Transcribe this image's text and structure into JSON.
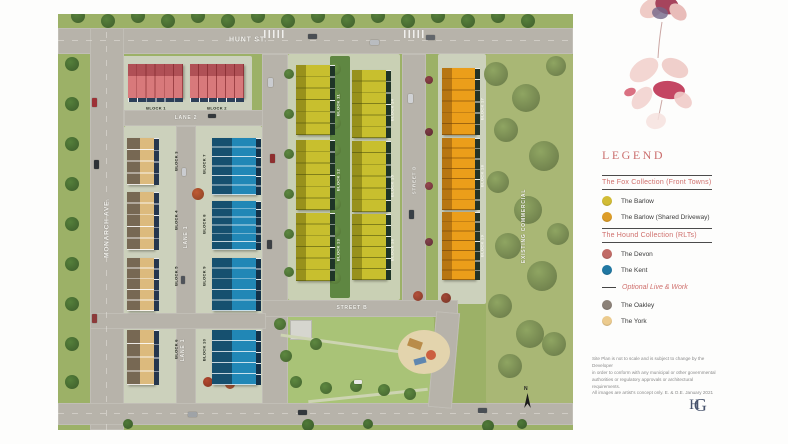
{
  "legend": {
    "title": "LEGEND",
    "sections": [
      {
        "style": "boxed",
        "heading": "The Fox Collection (Front Towns)",
        "items": [
          {
            "color": "#d2bc35",
            "label": "The Barlow"
          },
          {
            "color": "#dd9d28",
            "label": "The Barlow (Shared Driveway)"
          }
        ]
      },
      {
        "style": "boxed",
        "heading": "The Hound Collection (RLTs)",
        "items": [
          {
            "color": "#c16b66",
            "label": "The Devon"
          },
          {
            "color": "#2178a3",
            "label": "The Kent"
          }
        ]
      },
      {
        "style": "dash",
        "heading": "Optional Live & Work",
        "items": [
          {
            "color": "#8b8178",
            "label": "The Oakley"
          },
          {
            "color": "#eccb8e",
            "label": "The York"
          }
        ]
      }
    ],
    "disclaimer_lines": [
      "Site Plan is not to scale and is subject to change by the Developer",
      "in order to conform with any municipal or other governmental",
      "authorities or regulatory approvals or architectural requirements.",
      "All images are artist's concept only. E. & O.E. January 2021"
    ],
    "logo_h": "H",
    "logo_g": "G"
  },
  "siteplan": {
    "street_labels": [
      {
        "name": "HUNT ST.",
        "x": 190,
        "y": 26,
        "rot": 0,
        "size": 7
      },
      {
        "name": "MONARCH AVE.",
        "x": 49,
        "y": 214,
        "rot": -90,
        "size": 6.5
      },
      {
        "name": "LANE 2",
        "x": 128,
        "y": 104,
        "rot": 0,
        "size": 5
      },
      {
        "name": "LANE 1",
        "x": 128,
        "y": 223,
        "rot": -90,
        "size": 5
      },
      {
        "name": "LANE 1",
        "x": 125,
        "y": 336,
        "rot": -90,
        "size": 5
      },
      {
        "name": "STREET B",
        "x": 294,
        "y": 294,
        "rot": 0,
        "size": 5
      },
      {
        "name": "STREET D",
        "x": 356,
        "y": 166,
        "rot": -90,
        "size": 4.5
      }
    ],
    "area_labels": [
      {
        "name": "EXISTING COMMERCIAL",
        "x": 466,
        "y": 212,
        "rot": -90,
        "size": 5
      }
    ],
    "blocks": [
      {
        "label": "BLOCK 1",
        "type": "devon",
        "x": 70,
        "y": 50,
        "w": 55,
        "h": 34,
        "units": 6,
        "orient": "h",
        "strip": "bottom",
        "lx": 98,
        "ly": 94,
        "rot": 0,
        "lstyle": "dark"
      },
      {
        "label": "BLOCK 2",
        "type": "devon",
        "x": 132,
        "y": 50,
        "w": 54,
        "h": 34,
        "units": 6,
        "orient": "h",
        "strip": "bottom",
        "lx": 159,
        "ly": 94,
        "rot": 0,
        "lstyle": "dark"
      },
      {
        "label": "BLOCK 3",
        "type": "york",
        "x": 69,
        "y": 124,
        "w": 27,
        "h": 47,
        "units": 4,
        "orient": "v",
        "strip": "right",
        "lx": 118,
        "ly": 147,
        "rot": -90,
        "lstyle": "dark"
      },
      {
        "label": "BLOCK 4",
        "type": "york",
        "x": 69,
        "y": 178,
        "w": 27,
        "h": 58,
        "units": 5,
        "orient": "v",
        "strip": "right",
        "lx": 118,
        "ly": 206,
        "rot": -90,
        "lstyle": "dark"
      },
      {
        "label": "BLOCK 5",
        "type": "york",
        "x": 69,
        "y": 244,
        "w": 27,
        "h": 53,
        "units": 5,
        "orient": "v",
        "strip": "right",
        "lx": 118,
        "ly": 262,
        "rot": -90,
        "lstyle": "dark"
      },
      {
        "label": "BLOCK 6",
        "type": "york",
        "x": 69,
        "y": 316,
        "w": 27,
        "h": 55,
        "units": 4,
        "orient": "v",
        "strip": "right",
        "lx": 118,
        "ly": 335,
        "rot": -90,
        "lstyle": "dark"
      },
      {
        "label": "BLOCK 7",
        "type": "kent",
        "x": 154,
        "y": 124,
        "w": 44,
        "h": 57,
        "units": 6,
        "orient": "v",
        "strip": "right",
        "lx": 146,
        "ly": 150,
        "rot": -90,
        "lstyle": "dark"
      },
      {
        "label": "BLOCK 8",
        "type": "kent",
        "x": 154,
        "y": 187,
        "w": 44,
        "h": 49,
        "units": 6,
        "orient": "v",
        "strip": "right",
        "lx": 146,
        "ly": 210,
        "rot": -90,
        "lstyle": "dark"
      },
      {
        "label": "BLOCK 9",
        "type": "kent",
        "x": 154,
        "y": 244,
        "w": 44,
        "h": 53,
        "units": 5,
        "orient": "v",
        "strip": "right",
        "lx": 146,
        "ly": 262,
        "rot": -90,
        "lstyle": "dark"
      },
      {
        "label": "BLOCK 10",
        "type": "kent",
        "x": 154,
        "y": 316,
        "w": 44,
        "h": 55,
        "units": 5,
        "orient": "v",
        "strip": "right",
        "lx": 146,
        "ly": 336,
        "rot": -90,
        "lstyle": "dark"
      },
      {
        "label": "BLOCK 11",
        "type": "barlow",
        "x": 238,
        "y": 51,
        "w": 34,
        "h": 70,
        "units": 6,
        "orient": "v",
        "strip": "right",
        "lx": 280,
        "ly": 91,
        "rot": -90,
        "lstyle": "light"
      },
      {
        "label": "BLOCK 12",
        "type": "barlow",
        "x": 238,
        "y": 126,
        "w": 34,
        "h": 70,
        "units": 6,
        "orient": "v",
        "strip": "right",
        "lx": 280,
        "ly": 166,
        "rot": -90,
        "lstyle": "light"
      },
      {
        "label": "BLOCK 13",
        "type": "barlow",
        "x": 238,
        "y": 199,
        "w": 34,
        "h": 68,
        "units": 6,
        "orient": "v",
        "strip": "right",
        "lx": 280,
        "ly": 236,
        "rot": -90,
        "lstyle": "light"
      },
      {
        "label": "BLOCK 14",
        "type": "barlow",
        "x": 294,
        "y": 56,
        "w": 34,
        "h": 68,
        "units": 6,
        "orient": "v",
        "strip": "right",
        "lx": 334,
        "ly": 96,
        "rot": -90,
        "lstyle": "light"
      },
      {
        "label": "BLOCK 15",
        "type": "barlow",
        "x": 294,
        "y": 127,
        "w": 34,
        "h": 71,
        "units": 6,
        "orient": "v",
        "strip": "right",
        "lx": 334,
        "ly": 172,
        "rot": -90,
        "lstyle": "light"
      },
      {
        "label": "BLOCK 16",
        "type": "barlow",
        "x": 294,
        "y": 200,
        "w": 34,
        "h": 66,
        "units": 6,
        "orient": "v",
        "strip": "right",
        "lx": 334,
        "ly": 236,
        "rot": -90,
        "lstyle": "light"
      },
      {
        "label": "BLOCK 17",
        "type": "orange",
        "x": 384,
        "y": 54,
        "w": 33,
        "h": 67,
        "units": 6,
        "orient": "v",
        "strip": "right",
        "lx": 424,
        "ly": 95,
        "rot": -90,
        "lstyle": "light"
      },
      {
        "label": "BLOCK 18",
        "type": "orange",
        "x": 384,
        "y": 124,
        "w": 33,
        "h": 72,
        "units": 7,
        "orient": "v",
        "strip": "right",
        "lx": 424,
        "ly": 162,
        "rot": -90,
        "lstyle": "light"
      },
      {
        "label": "BLOCK 19",
        "type": "orange",
        "x": 384,
        "y": 198,
        "w": 33,
        "h": 68,
        "units": 7,
        "orient": "v",
        "strip": "right",
        "lx": 424,
        "ly": 232,
        "rot": -90,
        "lstyle": "light"
      }
    ],
    "compass_label": "N"
  }
}
